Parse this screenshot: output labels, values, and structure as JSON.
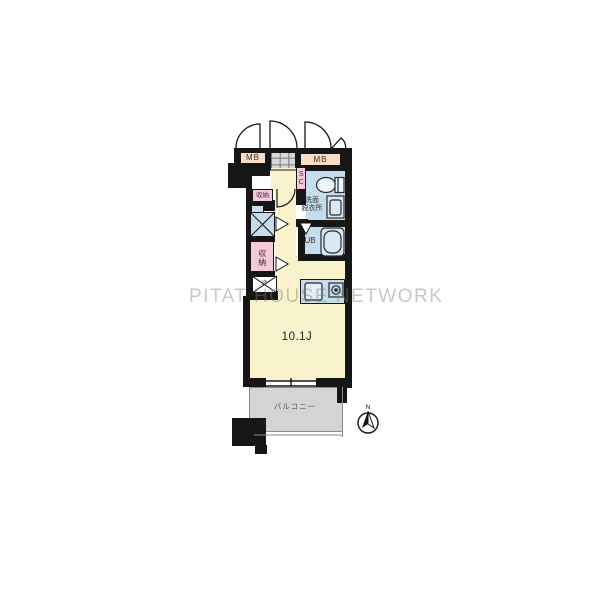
{
  "watermark": "PITAT HOUSE NETWORK",
  "floorplan": {
    "rooms": {
      "meter_box_left": "MB",
      "meter_box_right": "MB",
      "shoe_closet": "SC",
      "washroom_line1": "洗面",
      "washroom_line2": "脱衣所",
      "unit_bath": "UB",
      "closet_upper": "収納",
      "closet_lower": "収納",
      "refrigerator_mark": "冷",
      "main_room_size": "10.1J",
      "balcony": "バルコニー"
    },
    "compass": {
      "north": "N"
    },
    "colors": {
      "wall": "#161616",
      "room_yellow": "#f8f3cc",
      "wet_area_blue": "#c6ddee",
      "closet_pink": "#f5c9da",
      "meter_box_peach": "#f9dcc2",
      "tile_gray": "#d8d8d8",
      "balcony_gray": "#d4d4d4",
      "watermark_gray": "#c9c9c9"
    }
  }
}
